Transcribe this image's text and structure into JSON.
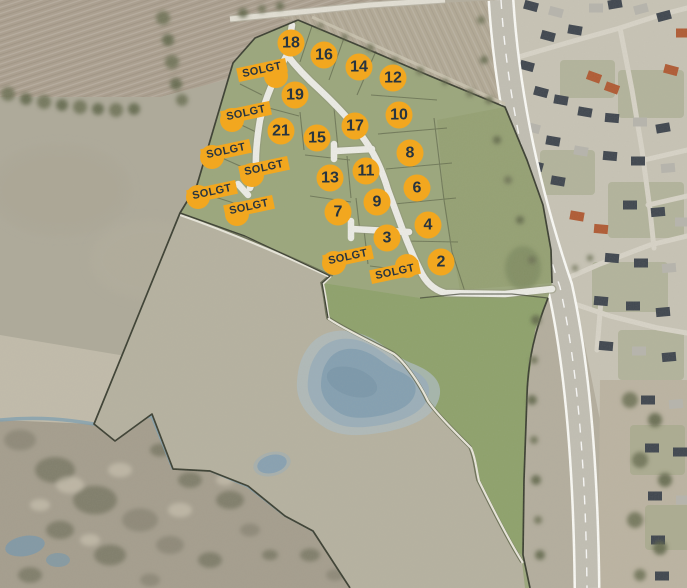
{
  "map": {
    "sold_label": "SOLGT",
    "sold_rotation_deg": -12,
    "plot_badges": [
      {
        "number": "18",
        "x": 291,
        "y": 43
      },
      {
        "number": "16",
        "x": 324,
        "y": 55
      },
      {
        "number": "14",
        "x": 359,
        "y": 67
      },
      {
        "number": "12",
        "x": 393,
        "y": 78
      },
      {
        "number": "19",
        "x": 295,
        "y": 95
      },
      {
        "number": "10",
        "x": 399,
        "y": 115
      },
      {
        "number": "21",
        "x": 281,
        "y": 131
      },
      {
        "number": "15",
        "x": 317,
        "y": 138
      },
      {
        "number": "17",
        "x": 355,
        "y": 126
      },
      {
        "number": "8",
        "x": 410,
        "y": 153
      },
      {
        "number": "13",
        "x": 330,
        "y": 178
      },
      {
        "number": "11",
        "x": 366,
        "y": 171
      },
      {
        "number": "6",
        "x": 417,
        "y": 188
      },
      {
        "number": "7",
        "x": 338,
        "y": 212
      },
      {
        "number": "9",
        "x": 377,
        "y": 202
      },
      {
        "number": "4",
        "x": 428,
        "y": 225
      },
      {
        "number": "3",
        "x": 387,
        "y": 238
      },
      {
        "number": "2",
        "x": 441,
        "y": 262
      }
    ],
    "sold_badges": [
      {
        "x": 262,
        "y": 70,
        "dot_dx": 14,
        "dot_dy": 6
      },
      {
        "x": 246,
        "y": 113,
        "dot_dx": -14,
        "dot_dy": 7
      },
      {
        "x": 226,
        "y": 151,
        "dot_dx": -14,
        "dot_dy": 6
      },
      {
        "x": 264,
        "y": 168,
        "dot_dx": -12,
        "dot_dy": 7
      },
      {
        "x": 212,
        "y": 192,
        "dot_dx": -14,
        "dot_dy": 5
      },
      {
        "x": 249,
        "y": 207,
        "dot_dx": -12,
        "dot_dy": 7
      },
      {
        "x": 348,
        "y": 257,
        "dot_dx": -14,
        "dot_dy": 6
      },
      {
        "x": 395,
        "y": 272,
        "dot_dx": 12,
        "dot_dy": -6
      }
    ]
  },
  "theme": {
    "badge-bg": "#F2A71F",
    "badge-text": "#273440",
    "site-green": "#9BA77C",
    "meadow-green": "#8EA26B",
    "buffer-green": "#95A173",
    "pasture-pale": "#B6B2A0",
    "water-blue": "#84A0B2",
    "road-white": "#EDEDE7",
    "boundary-dark": "#3A3E31"
  }
}
